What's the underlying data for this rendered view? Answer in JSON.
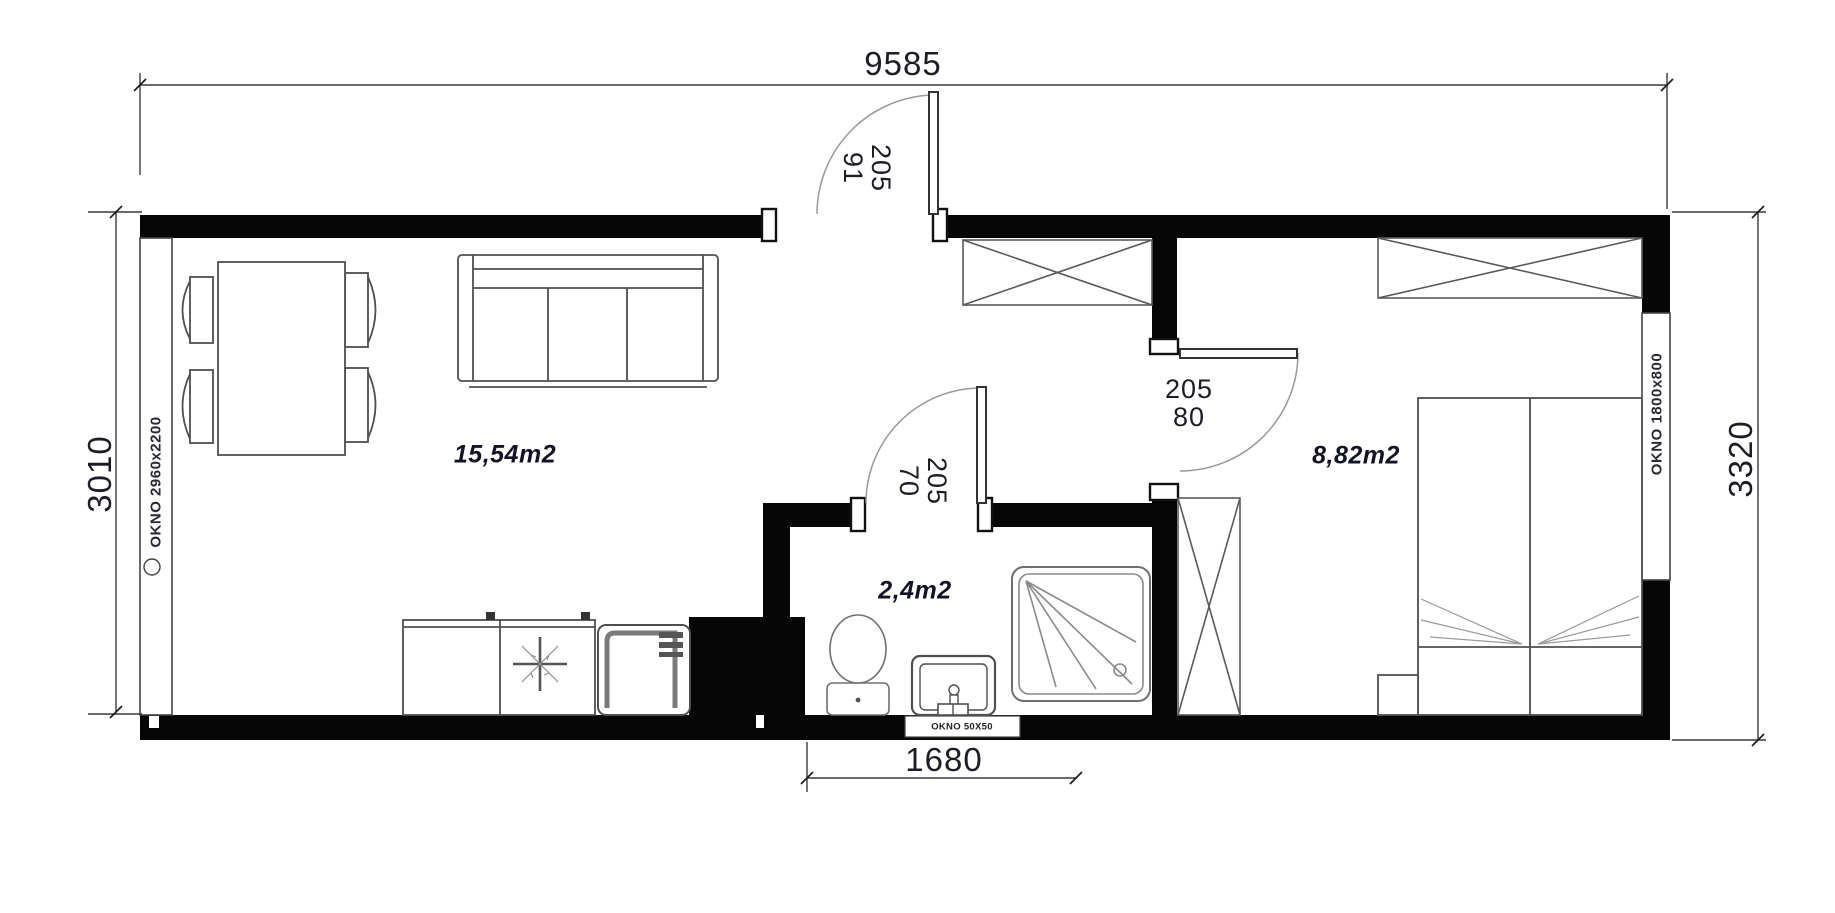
{
  "floor_plan": {
    "dimensions": {
      "overall_width_mm": "9585",
      "left_height_mm": "3010",
      "right_height_mm": "3320",
      "bathroom_width_mm": "1680"
    },
    "rooms": {
      "living_kitchen": {
        "area": "15,54m2"
      },
      "bathroom": {
        "area": "2,4m2"
      },
      "bedroom": {
        "area": "8,82m2"
      }
    },
    "doors": {
      "entrance": {
        "height_cm": "205",
        "width_cm": "91"
      },
      "bedroom": {
        "height_cm": "205",
        "width_cm": "80"
      },
      "bathroom": {
        "height_cm": "205",
        "width_cm": "70"
      }
    },
    "windows": {
      "living_room": {
        "label": "OKNO 2960x2200"
      },
      "bedroom": {
        "label": "OKNO 1800x800"
      },
      "bathroom": {
        "label": "OKNO 50X50"
      }
    },
    "colors": {
      "wall": "#060606",
      "furniture_line": "#4f4f4f",
      "dimension_text": "#1d1d26",
      "area_text": "#131327"
    }
  }
}
